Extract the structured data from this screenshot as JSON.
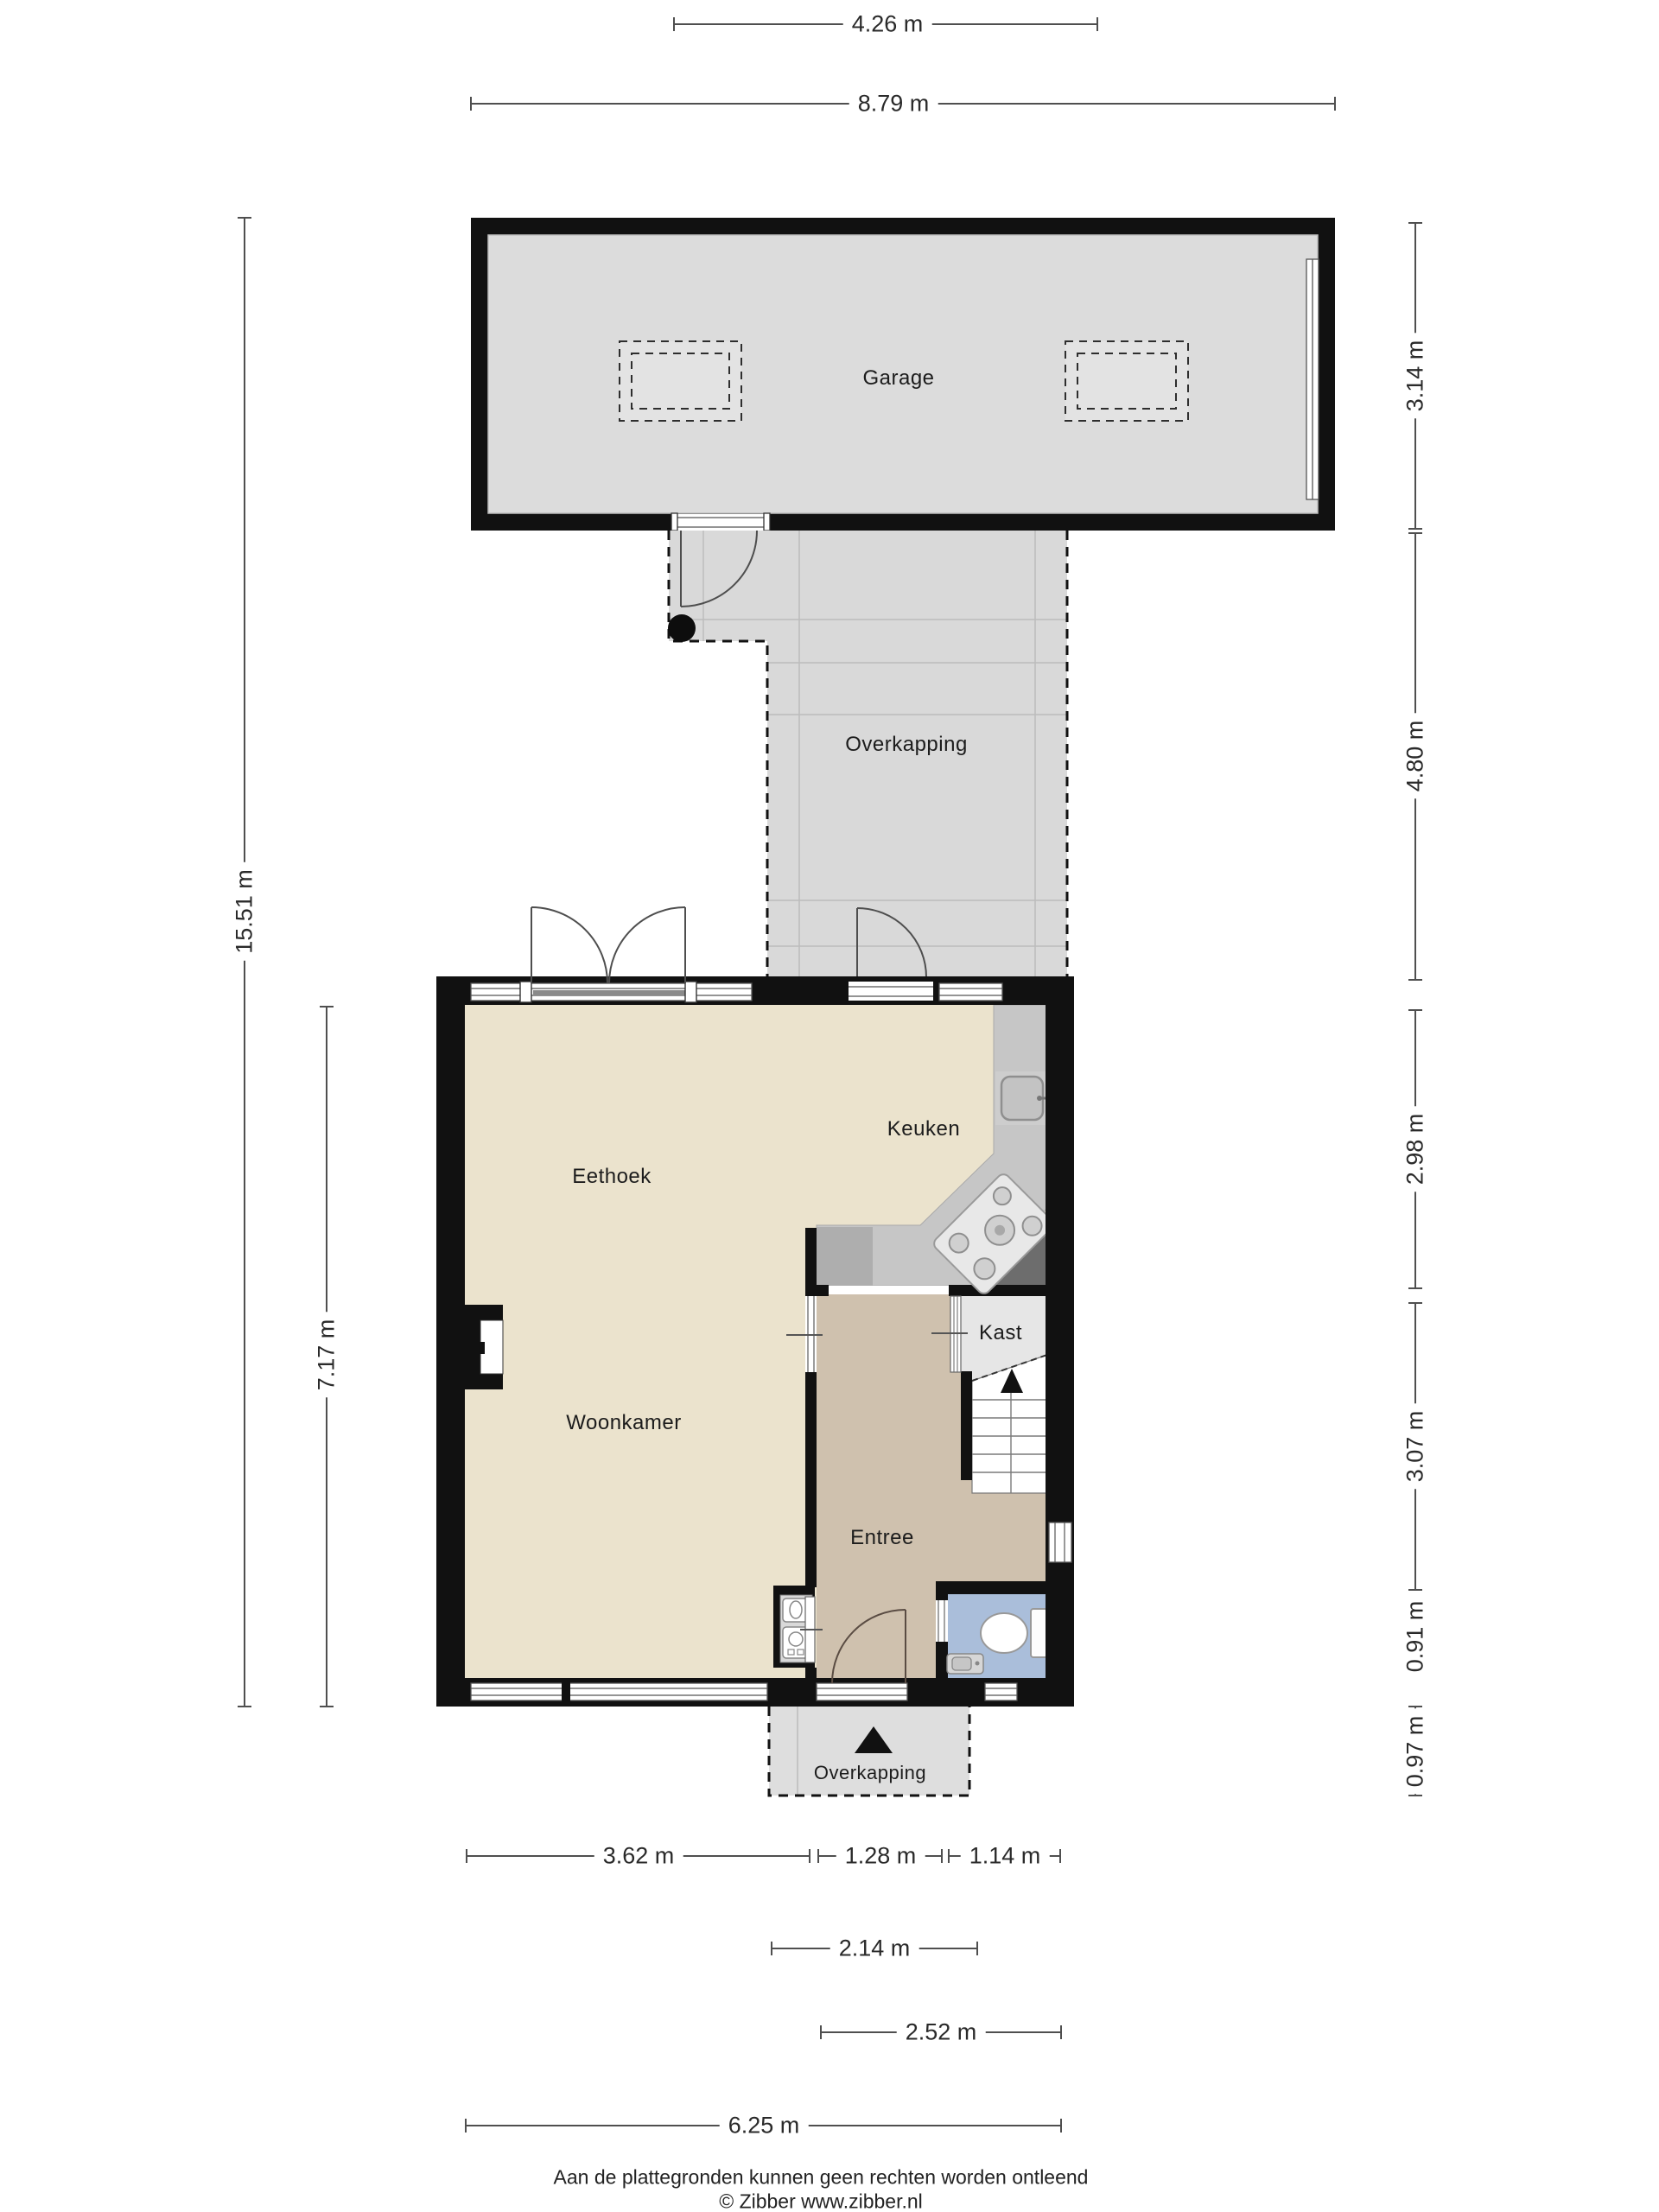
{
  "plan": {
    "title": "Begane grond plattegrond",
    "rooms": {
      "garage": {
        "label": "Garage"
      },
      "overkapping_top": {
        "label": "Overkapping"
      },
      "eethoek": {
        "label": "Eethoek"
      },
      "keuken": {
        "label": "Keuken"
      },
      "woonkamer": {
        "label": "Woonkamer"
      },
      "kast": {
        "label": "Kast"
      },
      "entree": {
        "label": "Entree"
      },
      "overkapping_bottom": {
        "label": "Overkapping"
      }
    },
    "dimensions": {
      "top": [
        {
          "label": "4.26 m"
        },
        {
          "label": "8.79 m"
        }
      ],
      "left": [
        {
          "label": "15.51 m"
        },
        {
          "label": "7.17 m"
        }
      ],
      "right": [
        {
          "label": "3.14 m"
        },
        {
          "label": "4.80 m"
        },
        {
          "label": "2.98 m"
        },
        {
          "label": "3.07 m"
        },
        {
          "label": "0.91 m"
        },
        {
          "label": "0.97 m"
        }
      ],
      "bottom": [
        {
          "label": "3.62 m"
        },
        {
          "label": "1.28 m"
        },
        {
          "label": "1.14 m"
        },
        {
          "label": "2.14 m"
        },
        {
          "label": "2.52 m"
        },
        {
          "label": "6.25 m"
        }
      ]
    },
    "icons": {
      "stair_arrow": "up-arrow",
      "entrance_marker": "up-triangle",
      "tree": "black-dot"
    },
    "colors": {
      "wall": "#111111",
      "garage_floor": "#dcdcdc",
      "overkapping_floor": "#d9d9d9",
      "living_floor": "#ebe3cd",
      "entree_floor": "#cfc1ae",
      "kast_floor": "#e6e6e6",
      "toilet_floor": "#aabeda",
      "counter": "#c6c6c6",
      "counter_dark": "#6d6d6d"
    },
    "footer": {
      "disclaimer": "Aan de plattegronden kunnen geen rechten worden ontleend",
      "credit": "© Zibber www.zibber.nl"
    }
  }
}
